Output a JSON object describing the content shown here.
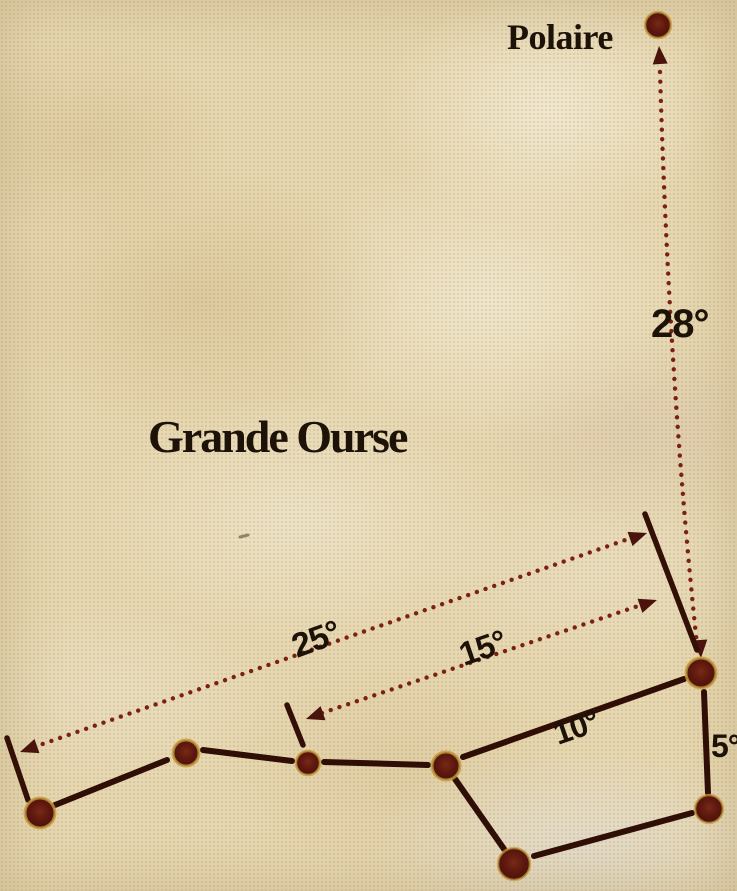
{
  "figure": {
    "labels": {
      "polaris_star": "Polaire",
      "constellation": "Grande Ourse"
    },
    "angle_labels": {
      "dipper_to_polaris": "28°",
      "full_dipper_span": "25°",
      "handle_to_bowl_span": "15°",
      "bowl_top_span": "10°",
      "pointer_stars_span": "5°"
    },
    "colors": {
      "background_parchment": "#ecddb6",
      "constellation_line": "#2f0e05",
      "dotted_arrow": "#7c2013",
      "star_fill": "#5e180e",
      "star_ring": "#c49a3c",
      "text": "#1c1208"
    }
  }
}
